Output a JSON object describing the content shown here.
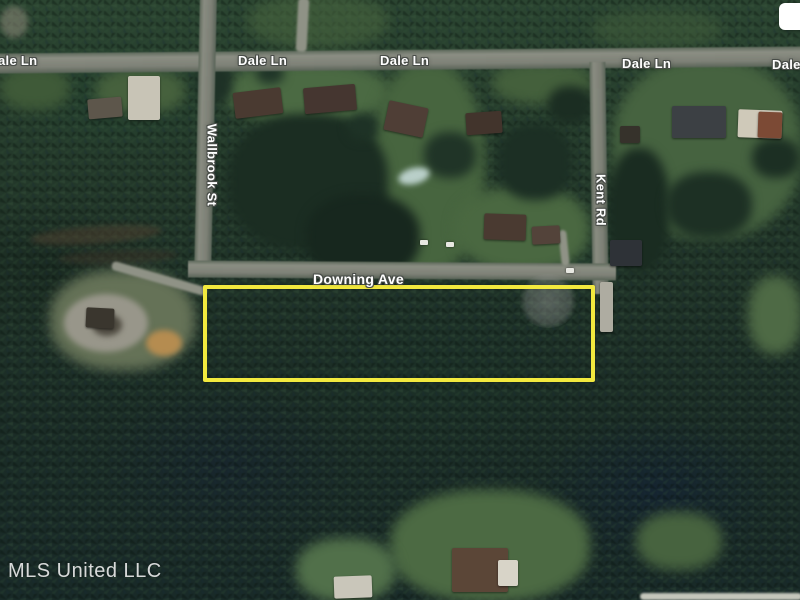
{
  "map": {
    "view_type": "satellite",
    "street_labels": {
      "dale_ln_partial_left": "ale Ln",
      "dale_ln_1": "Dale Ln",
      "dale_ln_2": "Dale Ln",
      "dale_ln_3": "Dale Ln",
      "dale_ln_partial_right": "Dale",
      "wallbrook_st": "Wallbrook St",
      "kent_rd": "Kent Rd",
      "downing_ave": "Downing Ave"
    },
    "parcel": {
      "outline_color": "#f2e93e",
      "description": "highlighted-lot-boundary"
    },
    "watermark": "MLS United LLC"
  },
  "colors": {
    "parcel_outline": "#f2e93e",
    "label_text": "#ffffff",
    "watermark_text": "#f2f2f2",
    "road": "#85887d",
    "forest": "#22352a"
  }
}
